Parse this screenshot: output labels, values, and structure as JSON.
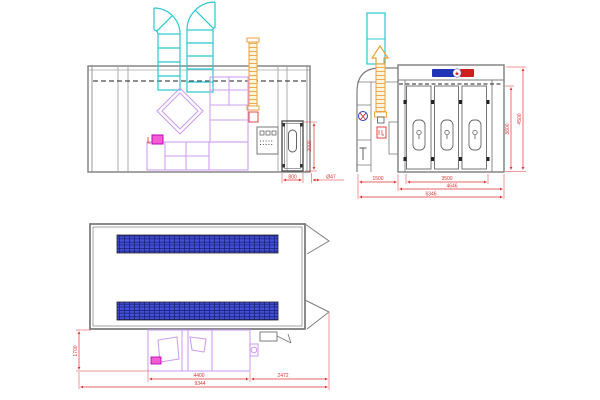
{
  "app": {
    "background": "#ffffff",
    "content": "spray-booth-cad-drawing"
  },
  "views": {
    "side_view": {
      "label": "side-elevation",
      "dimensions": {
        "door_height": "2000",
        "door_width": "800",
        "duct_diameter": "Ø47"
      }
    },
    "front_view": {
      "label": "front-elevation",
      "brand": {
        "star": "★"
      },
      "dimensions": {
        "cabinet_width": "1500",
        "door_opening_width": "3500",
        "booth_width": "4646",
        "total_width": "6346",
        "inner_height": "3600",
        "total_height": "4500"
      }
    },
    "plan_view": {
      "label": "top-plan",
      "dimensions": {
        "machine_room_length": "4400",
        "right_section_length": "2472",
        "total_length": "9344",
        "machine_room_depth": "1700"
      }
    }
  },
  "colors": {
    "outline_gray": "#7d7d7d",
    "joint_gray": "#9a9a9a",
    "duct_cyan": "#2bc8d0",
    "equipment_purple": "#cfa0f0",
    "chimney_orange": "#e8a23c",
    "dimension_red": "#e03434",
    "grating_blue": "#4450d4",
    "accent_magenta": "#f35fd3",
    "logo_blue": "#1f35b5",
    "logo_red": "#cf2020",
    "dark_line": "#222222"
  }
}
